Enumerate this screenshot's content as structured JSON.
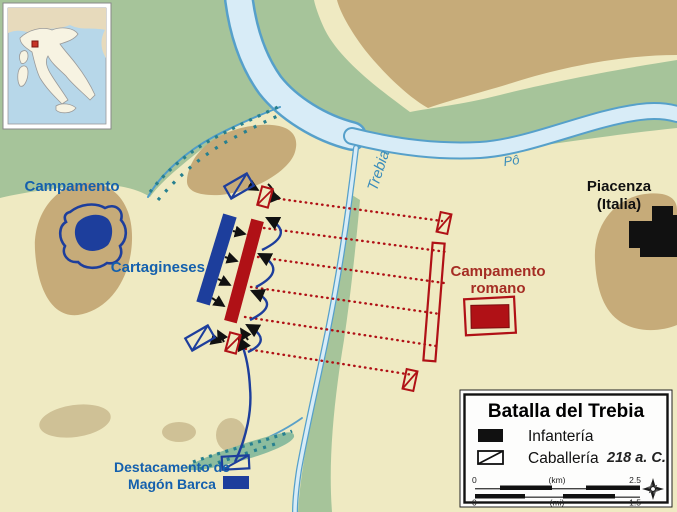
{
  "map": {
    "labels": {
      "carthaginian_camp": "Campamento",
      "carthaginians": "Cartagineses",
      "roman_camp_line1": "Campamento",
      "roman_camp_line2": "romano",
      "piacenza_line1": "Piacenza",
      "piacenza_line2": "(Italia)",
      "river_trebia": "Trebia",
      "river_po": "Pô",
      "detachment_line1": "Destacamento de",
      "detachment_line2": "Magón Barca"
    },
    "colors": {
      "background": "#efeac2",
      "lowland_green": "#a6c49a",
      "hill_tan": "#c6ab79",
      "hill_tan_light": "#cfc196",
      "marsh_green": "#8cbc9e",
      "river_fill": "#d8ecf7",
      "river_stroke": "#56a0ca",
      "carthaginian_blue": "#1d3e9c",
      "blue_label": "#1460ad",
      "roman_red": "#b01116",
      "red_label": "#a52d24",
      "marsh_teal": "#27808f",
      "city_black": "#111111"
    }
  },
  "legend": {
    "title": "Batalla del Trebia",
    "infantry_label": "Infantería",
    "cavalry_label": "Caballería",
    "year": "218 a. C.",
    "scale": {
      "km_start": "0",
      "km_unit": "(km)",
      "km_end": "2.5",
      "mi_start": "0",
      "mi_unit": "(mi)",
      "mi_end": "1.5"
    }
  }
}
